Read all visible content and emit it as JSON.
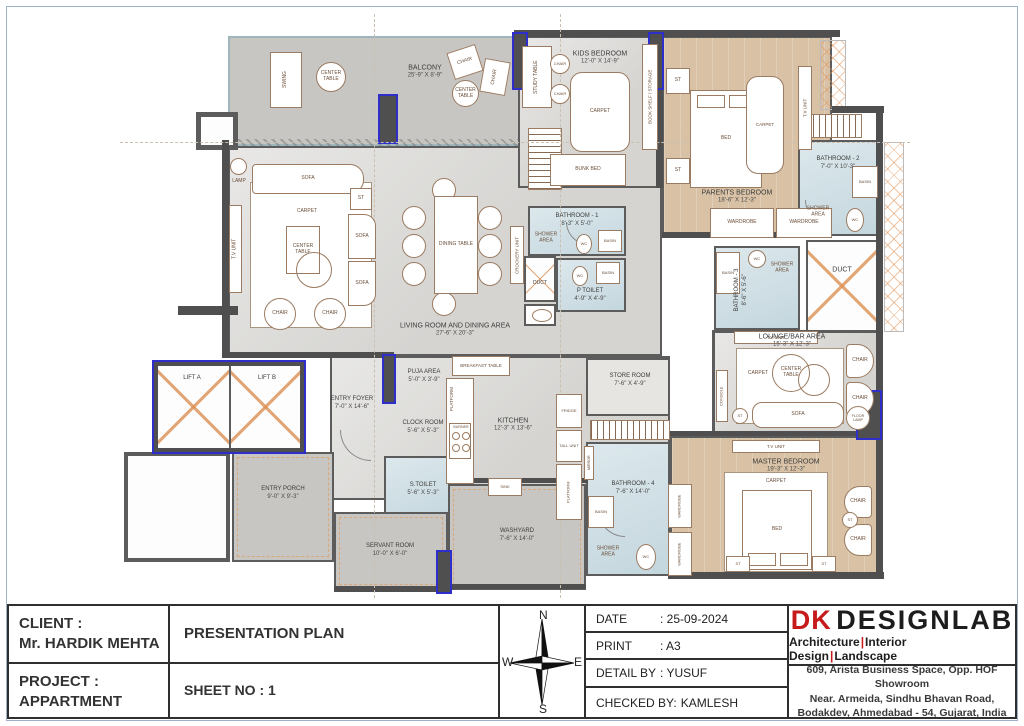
{
  "colors": {
    "accent_red": "#c61a1b",
    "wall": "#4f4f4f",
    "highlight_wall": "#2e2ecb",
    "wood_floor": "#d8c1a5",
    "bath_floor": "#cddee4",
    "marble_floor": "#dcdbd8",
    "paving": "#c7c6c3"
  },
  "plan": {
    "rooms": {
      "balcony": {
        "name": "BALCONY",
        "dims": "25'-9\" X 8'-9\""
      },
      "kids_bedroom": {
        "name": "KIDS BEDROOM",
        "dims": "12'-0\" X 14'-9\""
      },
      "parents_bedroom": {
        "name": "PARENTS BEDROOM",
        "dims": "18'-6\" X 12'-3\""
      },
      "bathroom_1": {
        "name": "BATHROOM - 1",
        "dims": "8'-3\" X 5'-0\""
      },
      "bathroom_2": {
        "name": "BATHROOM - 2",
        "dims": "7'-0\" X 10'-3\""
      },
      "bathroom_3": {
        "name": "BATHROOM - 3",
        "dims": "8'-6\" X 5'-6\""
      },
      "bathroom_4": {
        "name": "BATHROOM - 4",
        "dims": "7'-6\" X 14'-0\""
      },
      "p_toilet": {
        "name": "P TOILET",
        "dims": "4'-9\" X 4'-9\""
      },
      "living_dining": {
        "name": "LIVING ROOM AND DINING AREA",
        "dims": "27'-6\" X 20'-3\""
      },
      "lounge": {
        "name": "LOUNGE/BAR AREA",
        "dims": "15'-3\" X 12'-3\""
      },
      "master_bedroom": {
        "name": "MASTER BEDROOM",
        "dims": "19'-3\" X 12'-3\""
      },
      "kitchen": {
        "name": "KITCHEN",
        "dims": "12'-3\" X 13'-6\""
      },
      "store_room": {
        "name": "STORE ROOM",
        "dims": "7'-6\" X 4'-9\""
      },
      "entry_foyer": {
        "name": "ENTRY FOYER",
        "dims": "7'-0\" X 14'-6\""
      },
      "entry_porch": {
        "name": "ENTRY PORCH",
        "dims": "9'-0\" X 9'-3\""
      },
      "puja_area": {
        "name": "PUJA AREA",
        "dims": "5'-0\" X 3'-9\""
      },
      "clock_room": {
        "name": "CLOCK ROOM",
        "dims": "5'-6\" X 5'-3\""
      },
      "s_toilet": {
        "name": "S.TOILET",
        "dims": "5'-6\" X 5'-3\""
      },
      "servant_room": {
        "name": "SERVANT ROOM",
        "dims": "10'-0\" X 6'-0\""
      },
      "washyard": {
        "name": "WASHYARD",
        "dims": "7'-6\" X 14'-0\""
      },
      "lift_a": {
        "name": "LIFT A"
      },
      "lift_b": {
        "name": "LIFT B"
      },
      "duct": {
        "name": "DUCT"
      }
    },
    "furniture": {
      "sofa": "SOFA",
      "chair": "CHAIR",
      "center_table": "CENTER TABLE",
      "st": "ST",
      "carpet": "CARPET",
      "bed": "BED",
      "dining_table": "DINING TABLE",
      "tv_unit": "T.V UNIT",
      "crockery_unit": "CROCKERY UNIT",
      "swing": "SWING",
      "lamp": "LAMP",
      "floor_lamp": "FLOOR LAMP",
      "console": "CONSOLE",
      "wardrobe": "WARDROBE",
      "study_table": "STUDY TABLE",
      "bunk_bed": "BUNK BED",
      "book_shelf": "BOOK SHELF / STORAGE",
      "breakfast_table": "BREAKFAST TABLE",
      "platform": "PLATFORM",
      "burner": "BURNER",
      "sink": "SINK",
      "fridge": "FRIDGE",
      "tall_unit": "TALL UNIT",
      "mirror": "MIRROR",
      "basin": "BASIN",
      "wc": "WC",
      "shower_area": "SHOWER AREA"
    }
  },
  "title_block": {
    "client_label": "CLIENT :",
    "client_name": "Mr. HARDIK MEHTA",
    "project_label": "PROJECT :",
    "project_name": "APPARTMENT",
    "plan_title": "PRESENTATION PLAN",
    "sheet_no": "SHEET NO : 1",
    "rows": [
      {
        "label": "DATE",
        "value": ": 25-09-2024"
      },
      {
        "label": "PRINT",
        "value": ": A3"
      },
      {
        "label": "DETAIL BY",
        "value": ": YUSUF"
      },
      {
        "label": "CHECKED BY:",
        "value": "KAMLESH"
      }
    ]
  },
  "compass": {
    "n": "N",
    "e": "E",
    "s": "S",
    "w": "W"
  },
  "brand": {
    "logo_dk": "DK",
    "logo_rest": "DESIGNLAB",
    "tagline_parts": [
      "Architecture",
      "Interior Design",
      "Landscape"
    ],
    "separator": "|",
    "address_lines": [
      "609, Arista Business Space, Opp. HOF Showroom",
      "Near. Armeida, Sindhu Bhavan Road,",
      "Bodakdev, Ahmedabad - 54, Gujarat, India"
    ]
  }
}
